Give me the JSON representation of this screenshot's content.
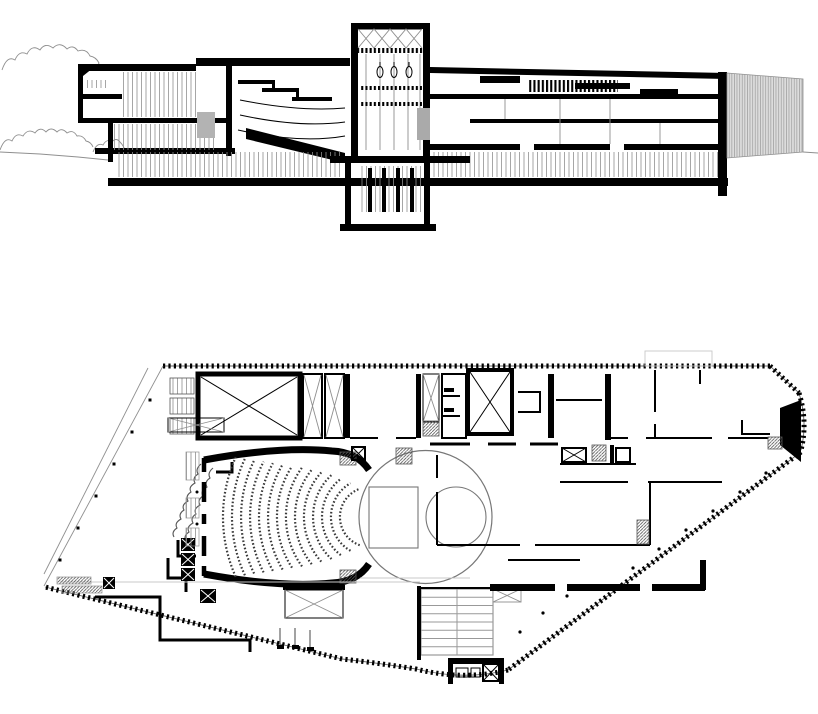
{
  "figure": {
    "type": "architectural-drawing",
    "views": [
      "longitudinal-section",
      "floor-plan"
    ],
    "background": "#ffffff"
  },
  "palette": {
    "ink": "#000000",
    "medium_line": "#555555",
    "light_line": "#8f8f8f",
    "pale_line": "#c8c8c8",
    "elevation_fill": "#dcdcdc",
    "stair_fill": "#b3b3b3",
    "seat_line": "#3a3a3a"
  },
  "section": {
    "name": "longitudinal-section",
    "fly_tower": {
      "left": 351,
      "right": 430,
      "top": 23,
      "stage_floor": 156,
      "pit_bottom": 231
    },
    "extent": {
      "left": 78,
      "right": 803,
      "ground_y": 152
    }
  },
  "plan": {
    "name": "floor-plan",
    "stage_circle": {
      "cx": 425.5,
      "cy": 517,
      "r": 66.5
    },
    "platform_circle": {
      "cx": 456,
      "cy": 517,
      "r": 30
    },
    "platform_rect": {
      "x": 369,
      "y": 487,
      "w": 49,
      "h": 61
    },
    "stage_house_box": {
      "x": 198,
      "y": 374,
      "w": 102,
      "h": 64
    },
    "seating": {
      "cx": 370,
      "cy": 517,
      "rows": [
        {
          "r": 30,
          "span": 140
        },
        {
          "r": 39,
          "span": 120
        },
        {
          "r": 48,
          "span": 105
        },
        {
          "r": 57,
          "span": 95
        },
        {
          "r": 66,
          "span": 85
        },
        {
          "r": 75,
          "span": 78
        },
        {
          "r": 84,
          "span": 72
        },
        {
          "r": 93,
          "span": 66
        },
        {
          "r": 102,
          "span": 62
        },
        {
          "r": 111,
          "span": 58
        },
        {
          "r": 120,
          "span": 55
        },
        {
          "r": 129,
          "span": 52
        },
        {
          "r": 138,
          "span": 50
        },
        {
          "r": 147,
          "span": 48
        }
      ],
      "row_style": {
        "dash": "1.6 2.1",
        "width": 2.2
      }
    },
    "stair_grid": {
      "x": 421,
      "y": 589,
      "w": 72,
      "h": 66,
      "treads": 8
    },
    "column_dots": [
      [
        766,
        473
      ],
      [
        740,
        492
      ],
      [
        713,
        511
      ],
      [
        686,
        530
      ],
      [
        659,
        549
      ],
      [
        633,
        568
      ],
      [
        567,
        596
      ],
      [
        543,
        613
      ],
      [
        520,
        632
      ]
    ],
    "edge_posts": [
      [
        150,
        400
      ],
      [
        132,
        432
      ],
      [
        114,
        464
      ],
      [
        96,
        496
      ],
      [
        78,
        528
      ],
      [
        60,
        560
      ]
    ],
    "site_boundary": {
      "segments": [
        "M163,366 H770",
        "M770,366 L799,393",
        "M799,393 Q808,422 801,450",
        "M801,452 L508,670",
        "M508,670 Q464,681 416,669 Q378,663 342,659",
        "M342,659 L45,587"
      ],
      "tick": {
        "width": 5,
        "dash": "2.2 3.2"
      }
    }
  }
}
